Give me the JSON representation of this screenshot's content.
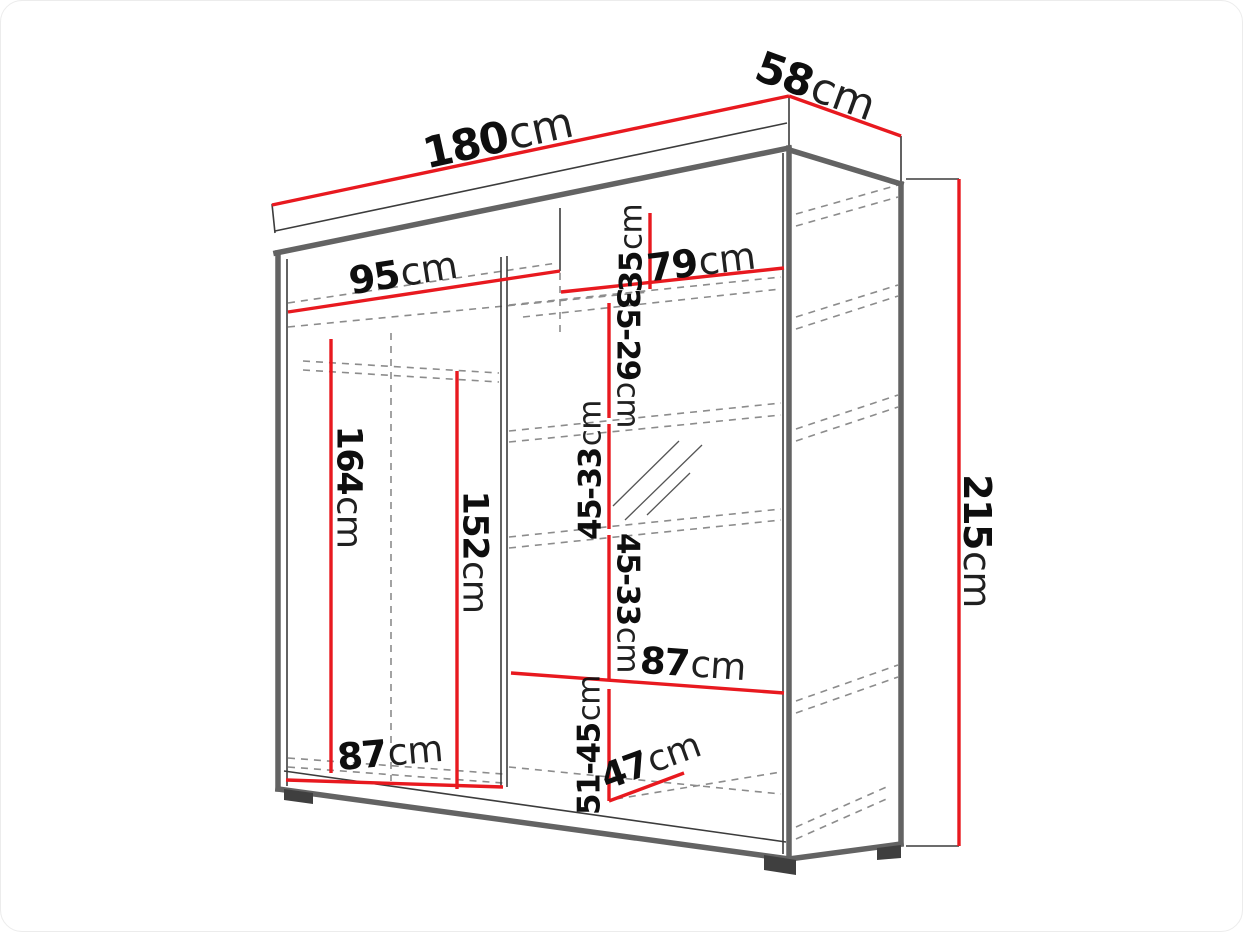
{
  "diagram": {
    "kind": "wardrobe-dimension-diagram",
    "unit": "cm",
    "colors": {
      "dimension_line": "#e8191f",
      "structure_edge": "#636363",
      "thin_edge": "#3c3c3c",
      "hidden_edge": "#8c8c8c",
      "label_text": "#0e0e0e",
      "background": "#ffffff"
    },
    "dims": {
      "total_width": {
        "num": "180",
        "unit": "cm"
      },
      "total_depth": {
        "num": "58",
        "unit": "cm"
      },
      "total_height": {
        "num": "215",
        "unit": "cm"
      },
      "left_section_width": {
        "num": "95",
        "unit": "cm"
      },
      "right_section_width": {
        "num": "79",
        "unit": "cm"
      },
      "top_shelf_gap": {
        "num": "35",
        "unit": "cm"
      },
      "shelf_gap_1": {
        "num": "35-29",
        "unit": "cm"
      },
      "shelf_gap_2": {
        "num": "45-33",
        "unit": "cm"
      },
      "shelf_gap_3": {
        "num": "45-33",
        "unit": "cm"
      },
      "hanging_height_left": {
        "num": "164",
        "unit": "cm"
      },
      "hanging_height_right": {
        "num": "152",
        "unit": "cm"
      },
      "shelf_width_right": {
        "num": "87",
        "unit": "cm"
      },
      "bottom_width_left": {
        "num": "87",
        "unit": "cm"
      },
      "bottom_gap": {
        "num": "51-45",
        "unit": "cm"
      },
      "bottom_shelf_depth": {
        "num": "47",
        "unit": "cm"
      }
    }
  }
}
